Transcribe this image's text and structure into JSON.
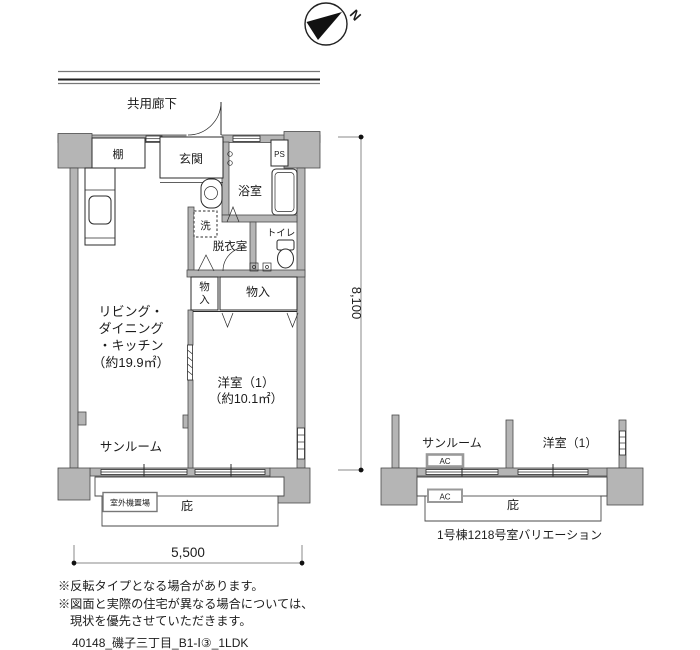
{
  "compass": {
    "north_label": "N"
  },
  "corridor_label": "共用廊下",
  "main_plan": {
    "labels": {
      "shelf": "棚",
      "entrance": "玄関",
      "ps": "PS",
      "bathroom": "浴室",
      "washer": "洗",
      "dressing_room": "脱衣室",
      "toilet": "トイレ",
      "closet_small_chars": [
        "物",
        "入"
      ],
      "closet_large": "物入",
      "ldk_lines": [
        "リビング・",
        "ダイニング",
        "・キッチン",
        "（約19.9㎡）"
      ],
      "western_room_lines": [
        "洋室（1）",
        "（約10.1㎡）"
      ],
      "sunroom": "サンルーム",
      "outdoor_unit": "室外機置場",
      "eaves": "庇"
    },
    "dimensions": {
      "height": "8,100",
      "width": "5,500"
    }
  },
  "variation_plan": {
    "labels": {
      "sunroom": "サンルーム",
      "western_room": "洋室（1）",
      "ac_top": "AC",
      "ac_bottom": "AC",
      "eaves": "庇"
    },
    "caption": "1号棟1218号室バリエーション"
  },
  "notes": [
    "※反転タイプとなる場合があります。",
    "※図面と実際の住宅が異なる場合については、",
    "現状を優先させていただきます。"
  ],
  "plan_code": "40148_磯子三丁目_B1-Ⅰ③_1LDK",
  "colors": {
    "wall_fill": "#b5b5b5",
    "line": "#2b2b2b",
    "dim_line": "#8a8a8a"
  }
}
